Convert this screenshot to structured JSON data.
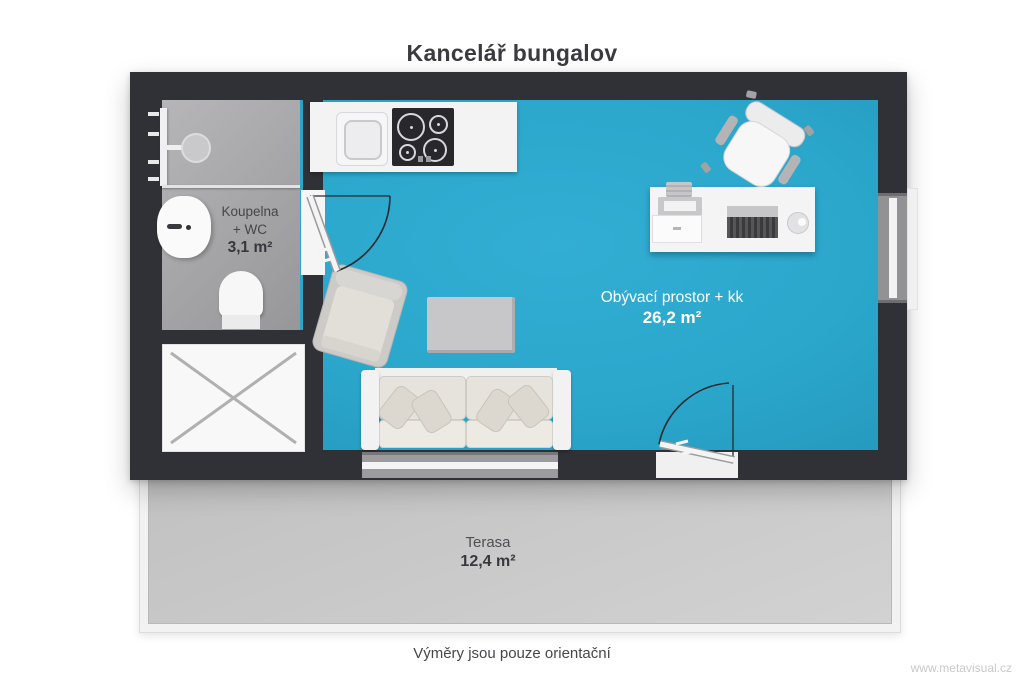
{
  "title": "Kancelář bungalov",
  "footnote": "Výměry jsou pouze orientační",
  "watermark": "www.metavisual.cz",
  "rooms": {
    "bathroom": {
      "name_line1": "Koupelna",
      "name_line2": "+ WC",
      "area": "3,1 m²"
    },
    "living": {
      "name": "Obývací prostor + kk",
      "area": "26,2 m²"
    },
    "terrace": {
      "name": "Terasa",
      "area": "12,4 m²"
    }
  },
  "colors": {
    "living_floor": "#2BA8CE",
    "wall": "#303136",
    "bathroom_floor": "#A8A8AC",
    "terrace_floor": "#C9C9C9",
    "label_light": "#FFFFFF",
    "label_dark": "#3A3A40"
  }
}
